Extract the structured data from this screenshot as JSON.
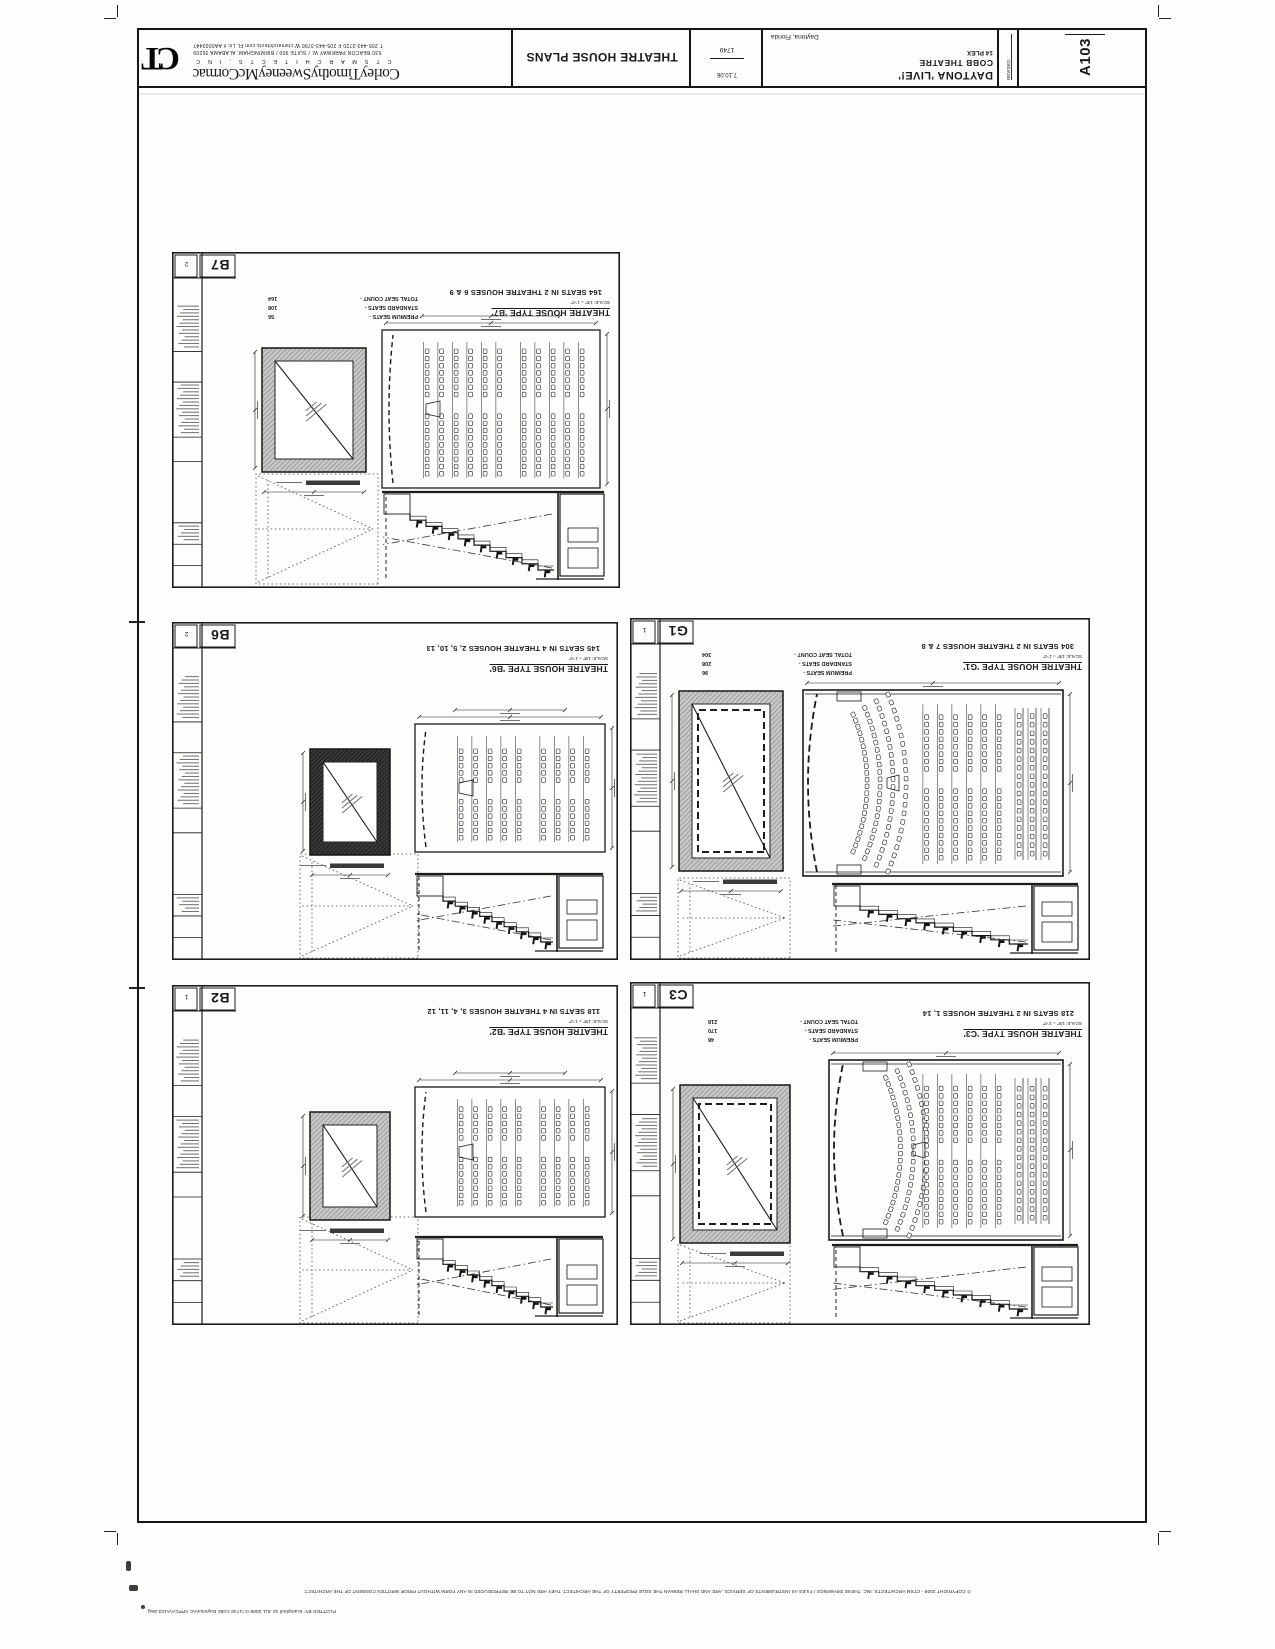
{
  "sheet": {
    "number": "A103",
    "title": "THEATRE HOUSE PLANS",
    "revised_label": "REVISED:",
    "date": "7.10.06",
    "project_no": "1749",
    "project": {
      "line1": "DAYTONA 'LIVE!'",
      "line2": "COBB THEATRE",
      "line3": "14 PLEX",
      "location": "Daytona, Florida"
    },
    "firm": {
      "logo": "CT",
      "name": "CorleyTimothySweeneyMcCormac",
      "subtitle": "C T S M   A R C H I T E C T S ,   I N C",
      "address": "530 BEACON PARKWAY W. / SUITE 900 / BIRMINGHAM, ALABAMA 35209",
      "contact": "T 205-443-3720    F 205-443-3790    W ctsmarchitects.com    FL Lic # AA0003447"
    },
    "plot_stamp": "PLOTTED    BY: kcampbell    10 JUL 2008    G:\\1749 Cobb Daytona\\AC APPCA\\A103.dwg",
    "copyright": "© COPYRIGHT 2008 - CTSM ARCHITECTS, INC.  THESE DRAWINGS / FILES AS INSTRUMENTS OF SERVICE, ARE AND SHALL REMAIN THE SOLE PROPERTY OF THE ARCHITECT.  THEY ARE NOT TO BE REPRODUCED IN ANY FORM WITHOUT PRIOR WRITTEN CONSENT OF THE ARCHITECT."
  },
  "panels": [
    {
      "id": "B7",
      "ref": "2",
      "type_line": "THEATRE HOUSE TYPE 'B7'",
      "scale_line": "SCALE: 1/8\" = 1'-0\"",
      "seats_line": "164 SEATS IN 2 THEATRE HOUSES 6 & 9",
      "counts": [
        {
          "label": "PREMIUM SEATS -",
          "value": "56"
        },
        {
          "label": "STANDARD SEATS -",
          "value": "108"
        },
        {
          "label": "TOTAL SEAT COUNT -",
          "value": "164"
        }
      ]
    },
    {
      "id": "B6",
      "ref": "2",
      "type_line": "THEATRE HOUSE TYPE 'B6'",
      "scale_line": "SCALE: 1/8\" = 1'-0\"",
      "seats_line": "145 SEATS IN 4 THEATRE HOUSES 2, 5, 10, 13",
      "counts": []
    },
    {
      "id": "B2",
      "ref": "1",
      "type_line": "THEATRE HOUSE TYPE 'B2'",
      "scale_line": "SCALE: 1/8\" = 1'-0\"",
      "seats_line": "118 SEATS IN 4 THEATRE HOUSES 3, 4, 11, 12",
      "counts": []
    },
    {
      "id": "G1",
      "ref": "1",
      "type_line": "THEATRE HOUSE TYPE 'G1'",
      "scale_line": "SCALE: 1/8\" = 1'-0\"",
      "seats_line": "304 SEATS IN 2 THEATRE HOUSES 7 & 8",
      "counts": [
        {
          "label": "PREMIUM SEATS -",
          "value": "96"
        },
        {
          "label": "STANDARD SEATS -",
          "value": "208"
        },
        {
          "label": "TOTAL SEAT COUNT -",
          "value": "304"
        }
      ]
    },
    {
      "id": "C3",
      "ref": "1",
      "type_line": "THEATRE HOUSE TYPE 'C3'",
      "scale_line": "SCALE: 1/8\" = 1'-0\"",
      "seats_line": "218 SEATS IN 2 THEATRE HOUSES 1, 14",
      "counts": [
        {
          "label": "PREMIUM SEATS -",
          "value": "48"
        },
        {
          "label": "STANDARD SEATS -",
          "value": "170"
        },
        {
          "label": "TOTAL SEAT COUNT -",
          "value": "218"
        }
      ]
    }
  ]
}
